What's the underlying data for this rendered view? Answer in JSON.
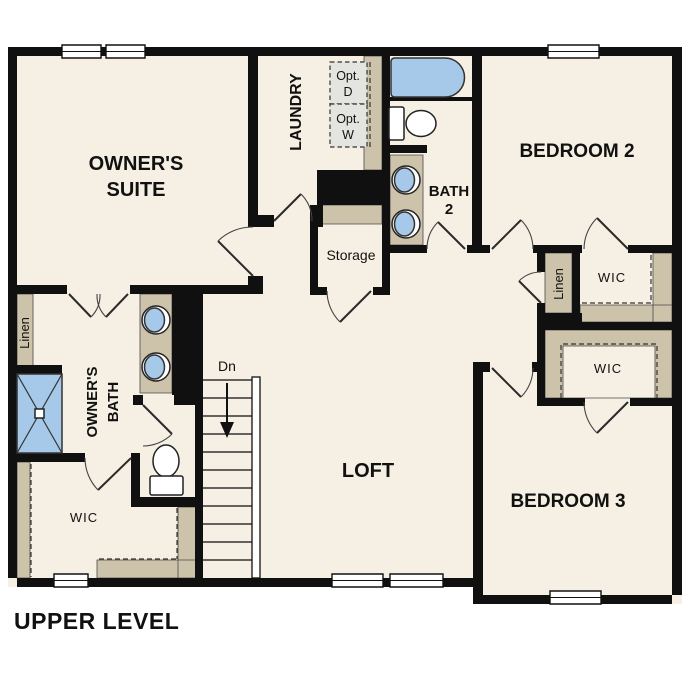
{
  "title": "UPPER LEVEL",
  "colors": {
    "floor": "#f6efe3",
    "wall": "#101010",
    "tan": "#cdc2aa",
    "fixture_blue": "#a6c9e9",
    "optional_gray": "#e4e4e0",
    "line": "#333333",
    "text": "#111111"
  },
  "rooms": {
    "owners_suite": {
      "line1": "OWNER'S",
      "line2": "SUITE"
    },
    "laundry": {
      "label": "LAUNDRY"
    },
    "optional_dryer": {
      "line1": "Opt.",
      "line2": "D"
    },
    "optional_washer": {
      "line1": "Opt.",
      "line2": "W"
    },
    "bath2": {
      "line1": "BATH",
      "line2": "2"
    },
    "bedroom2": {
      "label": "BEDROOM 2"
    },
    "storage": {
      "label": "Storage"
    },
    "linen_hall": {
      "label": "Linen"
    },
    "wic_bedroom2": {
      "label": "WIC"
    },
    "wic_bedroom3": {
      "label": "WIC"
    },
    "linen_owners": {
      "label": "Linen"
    },
    "owners_bath": {
      "line1": "OWNER'S",
      "line2": "BATH"
    },
    "wic_owners": {
      "label": "WIC"
    },
    "loft": {
      "label": "LOFT"
    },
    "bedroom3": {
      "label": "BEDROOM 3"
    },
    "stairs": {
      "label": "Dn"
    }
  }
}
